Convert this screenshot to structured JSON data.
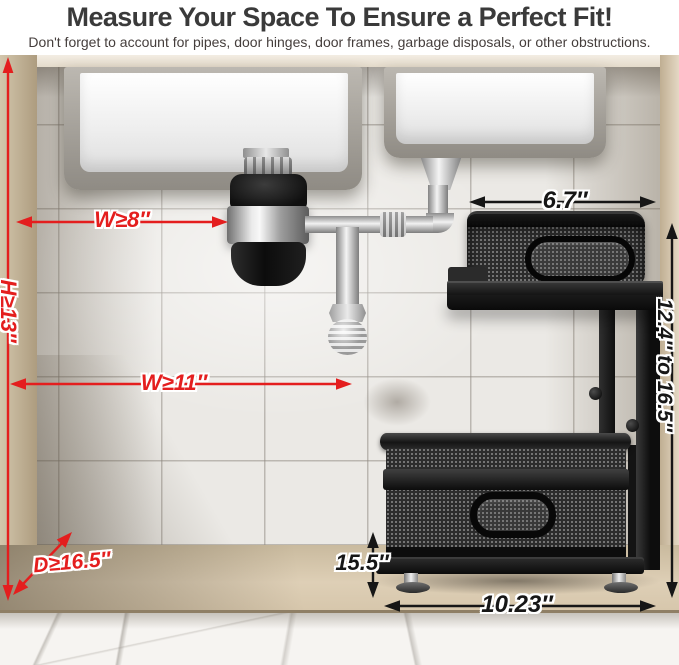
{
  "header": {
    "title": "Measure Your Space To Ensure a Perfect Fit!",
    "subtitle": "Don't forget to account for pipes, door hinges, door frames, garbage disposals, or other obstructions."
  },
  "annotations": {
    "min_height": "H≥13″",
    "min_width_disposal": "W≥8″",
    "min_width": "W≥11″",
    "min_depth": "D≥16.5″",
    "top_basket_width": "6.7″",
    "adjustable_height": "12.4″ to 16.5″",
    "bottom_tier_height": "15.5″",
    "bottom_basket_width": "10.23″"
  },
  "colors": {
    "annotation_red": "#e41e1e",
    "annotation_black": "#161616",
    "title_text": "#3a3a3a",
    "subtitle_text": "#453e3c"
  }
}
